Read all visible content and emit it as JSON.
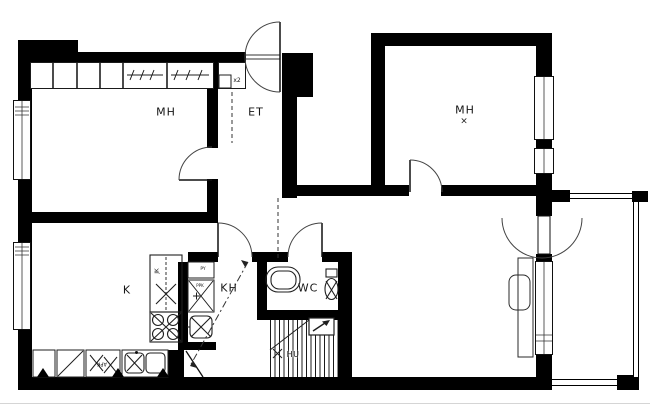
{
  "document": {
    "type": "apartment floor plan drawing"
  },
  "rooms": {
    "bedroom_left": {
      "label": "MH"
    },
    "entry": {
      "label": "ET"
    },
    "bedroom_right": {
      "label": "MH",
      "marker": "×"
    },
    "kitchen": {
      "label": "K"
    },
    "bathroom": {
      "label": "KH"
    },
    "toilet": {
      "label": "WC"
    },
    "stairwell": {
      "label": "HU"
    }
  },
  "annotations": {
    "closet_count": "x2",
    "fridge": "JK",
    "dishwasher": "APK",
    "laundry_top": "PY",
    "washer_reserve": "PPK"
  },
  "colors": {
    "wall": "#000000",
    "background": "#ffffff",
    "line": "#1c1c1c"
  }
}
